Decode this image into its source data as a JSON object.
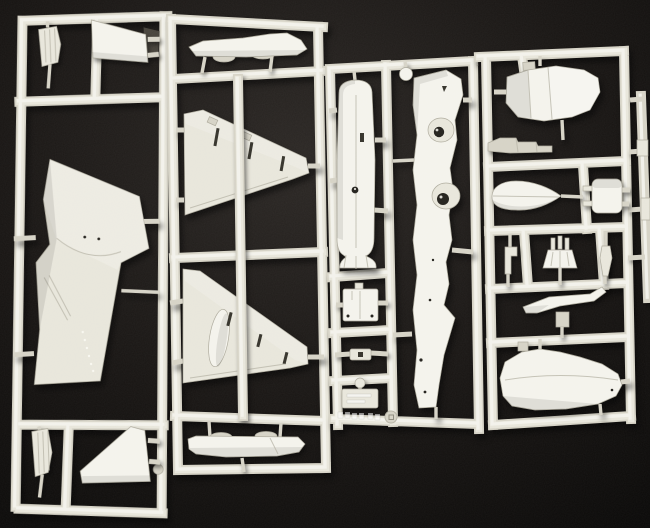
{
  "scene": {
    "type": "photograph",
    "subject": "Four white injection-molded plastic model-kit sprues with aircraft parts on a black background",
    "colors": {
      "background": "#131110",
      "vignette_center": "#2b2724",
      "plastic": "#e8e6db",
      "plastic_bright": "#f4f3ec",
      "plastic_dim": "#d6d3c6",
      "plastic_shadow": "#aeab9d",
      "recess": "#35332b"
    },
    "sprues": [
      {
        "label": "Left sprue: one-piece delta wing, two fins, two slatted flap parts"
      },
      {
        "label": "Second sprue: two lower wing halves with slat slots, two belly strake pieces"
      },
      {
        "label": "Middle sprue: two fuselage halves with wheel wells, access panels, embossed name plate"
      },
      {
        "label": "Right sprue: nose section, rear fuselage section, drop tank half, seat and small fittings"
      }
    ],
    "markings": {
      "mold_circle": "small circled mold mark on bottom rail",
      "embossed_text": "illegible raised lettering embossed on bottom rail and name plate"
    }
  }
}
